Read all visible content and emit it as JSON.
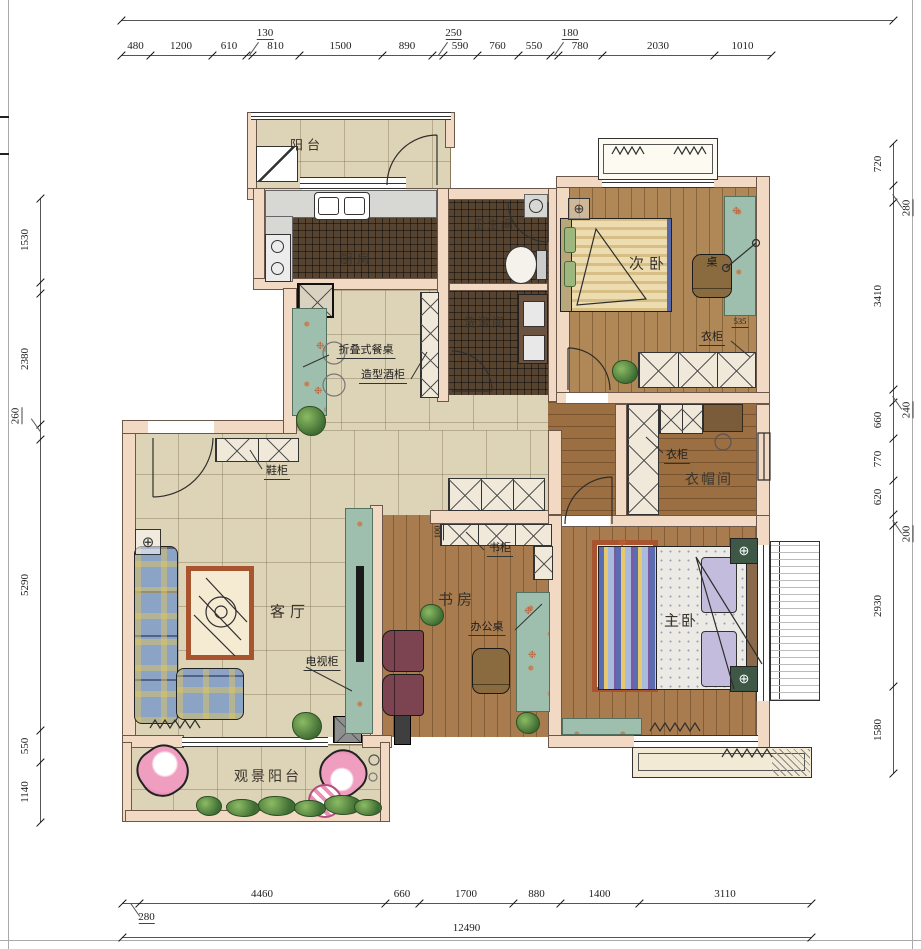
{
  "drawing": {
    "type": "apartment-floor-plan",
    "units": "mm"
  },
  "colors": {
    "wall": "#f2d9c3",
    "tile_floor": "#ddd3b6",
    "dark_tile_floor": "#564430",
    "wood_floor": "#a87c4e",
    "cabinet_teal": "#9fbfae",
    "chair_pink": "#e891b4",
    "text": "#2b2b2b",
    "dimension_text": "#222222"
  },
  "rooms": [
    {
      "id": "balcony-top",
      "label": "阳台",
      "x": 307,
      "y": 144,
      "size": 13,
      "ls": 4
    },
    {
      "id": "kitchen",
      "label": "厨房",
      "x": 357,
      "y": 258,
      "size": 13,
      "ls": 4
    },
    {
      "id": "bathroom",
      "label": "卫生间",
      "x": 494,
      "y": 224,
      "size": 12,
      "ls": 2
    },
    {
      "id": "washroom",
      "label": "洗漱间",
      "x": 485,
      "y": 322,
      "size": 12,
      "ls": 2
    },
    {
      "id": "second-bedroom",
      "label": "次卧",
      "x": 649,
      "y": 263,
      "size": 15,
      "ls": 5
    },
    {
      "id": "cloakroom",
      "label": "衣帽间",
      "x": 709,
      "y": 479,
      "size": 14,
      "ls": 2
    },
    {
      "id": "living-room",
      "label": "客厅",
      "x": 290,
      "y": 611,
      "size": 15,
      "ls": 5
    },
    {
      "id": "study",
      "label": "书房",
      "x": 457,
      "y": 599,
      "size": 15,
      "ls": 4
    },
    {
      "id": "master-bedroom",
      "label": "主卧",
      "x": 681,
      "y": 620,
      "size": 15,
      "ls": 2
    },
    {
      "id": "view-balcony",
      "label": "观景阳台",
      "x": 268,
      "y": 776,
      "size": 14,
      "ls": 3
    }
  ],
  "annotations": [
    {
      "id": "folding-dining-table",
      "label": "折叠式餐桌",
      "x": 366,
      "y": 350
    },
    {
      "id": "wine-cabinet",
      "label": "造型酒柜",
      "x": 383,
      "y": 375
    },
    {
      "id": "shoe-cabinet",
      "label": "鞋柜",
      "x": 277,
      "y": 471
    },
    {
      "id": "wardrobe-bedroom2",
      "label": "衣柜",
      "x": 712,
      "y": 337
    },
    {
      "id": "wardrobe-cloakroom",
      "label": "衣柜",
      "x": 677,
      "y": 455
    },
    {
      "id": "bookcase",
      "label": "书柜",
      "x": 500,
      "y": 548
    },
    {
      "id": "tv-cabinet",
      "label": "电视柜",
      "x": 322,
      "y": 662
    },
    {
      "id": "office-desk",
      "label": "办公桌",
      "x": 487,
      "y": 627
    },
    {
      "id": "desk-bedroom2",
      "label": "桌",
      "x": 712,
      "y": 262,
      "plain": true
    },
    {
      "id": "dim-535",
      "label": "535",
      "x": 740,
      "y": 322,
      "small": true
    },
    {
      "id": "dim-100",
      "label": "100",
      "x": 438,
      "y": 532,
      "small": true,
      "rot": true
    }
  ],
  "dimensions": {
    "top": {
      "axis": "x",
      "line": 55,
      "start": 121,
      "segments": [
        {
          "v": "480",
          "len": 29
        },
        {
          "v": "1200",
          "len": 62
        },
        {
          "v": "610",
          "len": 34
        },
        {
          "v": "130",
          "len": 6,
          "off": true
        },
        {
          "v": "810",
          "len": 47
        },
        {
          "v": "1500",
          "len": 83
        },
        {
          "v": "890",
          "len": 50
        },
        {
          "v": "250",
          "len": 11,
          "off": true
        },
        {
          "v": "590",
          "len": 34
        },
        {
          "v": "760",
          "len": 41
        },
        {
          "v": "550",
          "len": 32
        },
        {
          "v": "180",
          "len": 8,
          "off": true
        },
        {
          "v": "780",
          "len": 44
        },
        {
          "v": "2030",
          "len": 112
        },
        {
          "v": "1010",
          "len": 57
        }
      ]
    },
    "top_overall": {
      "axis": "x",
      "line": 20,
      "start": 121,
      "segments": [
        {
          "v": "",
          "len": 772
        }
      ]
    },
    "bottom": {
      "axis": "x",
      "line": 903,
      "start": 122,
      "segments": [
        {
          "v": "280",
          "len": 17,
          "off": true,
          "below": true
        },
        {
          "v": "4460",
          "len": 246
        },
        {
          "v": "660",
          "len": 34
        },
        {
          "v": "1700",
          "len": 94
        },
        {
          "v": "880",
          "len": 47
        },
        {
          "v": "1400",
          "len": 79
        },
        {
          "v": "3110",
          "len": 172
        }
      ]
    },
    "bottom_total": {
      "axis": "x",
      "line": 937,
      "start": 122,
      "segments": [
        {
          "v": "12490",
          "len": 689
        }
      ]
    },
    "left": {
      "axis": "y",
      "line": 40,
      "start": 198,
      "side": "left",
      "segments": [
        {
          "v": "1530",
          "len": 84
        },
        {
          "v": "",
          "len": 11
        },
        {
          "v": "2380",
          "len": 131
        },
        {
          "v": "260",
          "len": 15,
          "off": true
        },
        {
          "v": "5290",
          "len": 291
        },
        {
          "v": "550",
          "len": 32
        },
        {
          "v": "1140",
          "len": 60
        }
      ]
    },
    "right": {
      "axis": "y",
      "line": 893,
      "start": 143,
      "side": "right",
      "segments": [
        {
          "v": "720",
          "len": 42
        },
        {
          "v": "280",
          "len": 17,
          "off": true
        },
        {
          "v": "3410",
          "len": 187
        },
        {
          "v": "240",
          "len": 13,
          "off": true
        },
        {
          "v": "660",
          "len": 36
        },
        {
          "v": "770",
          "len": 42
        },
        {
          "v": "620",
          "len": 34
        },
        {
          "v": "200",
          "len": 11,
          "off": true
        },
        {
          "v": "2930",
          "len": 161
        },
        {
          "v": "1580",
          "len": 87
        }
      ]
    }
  }
}
